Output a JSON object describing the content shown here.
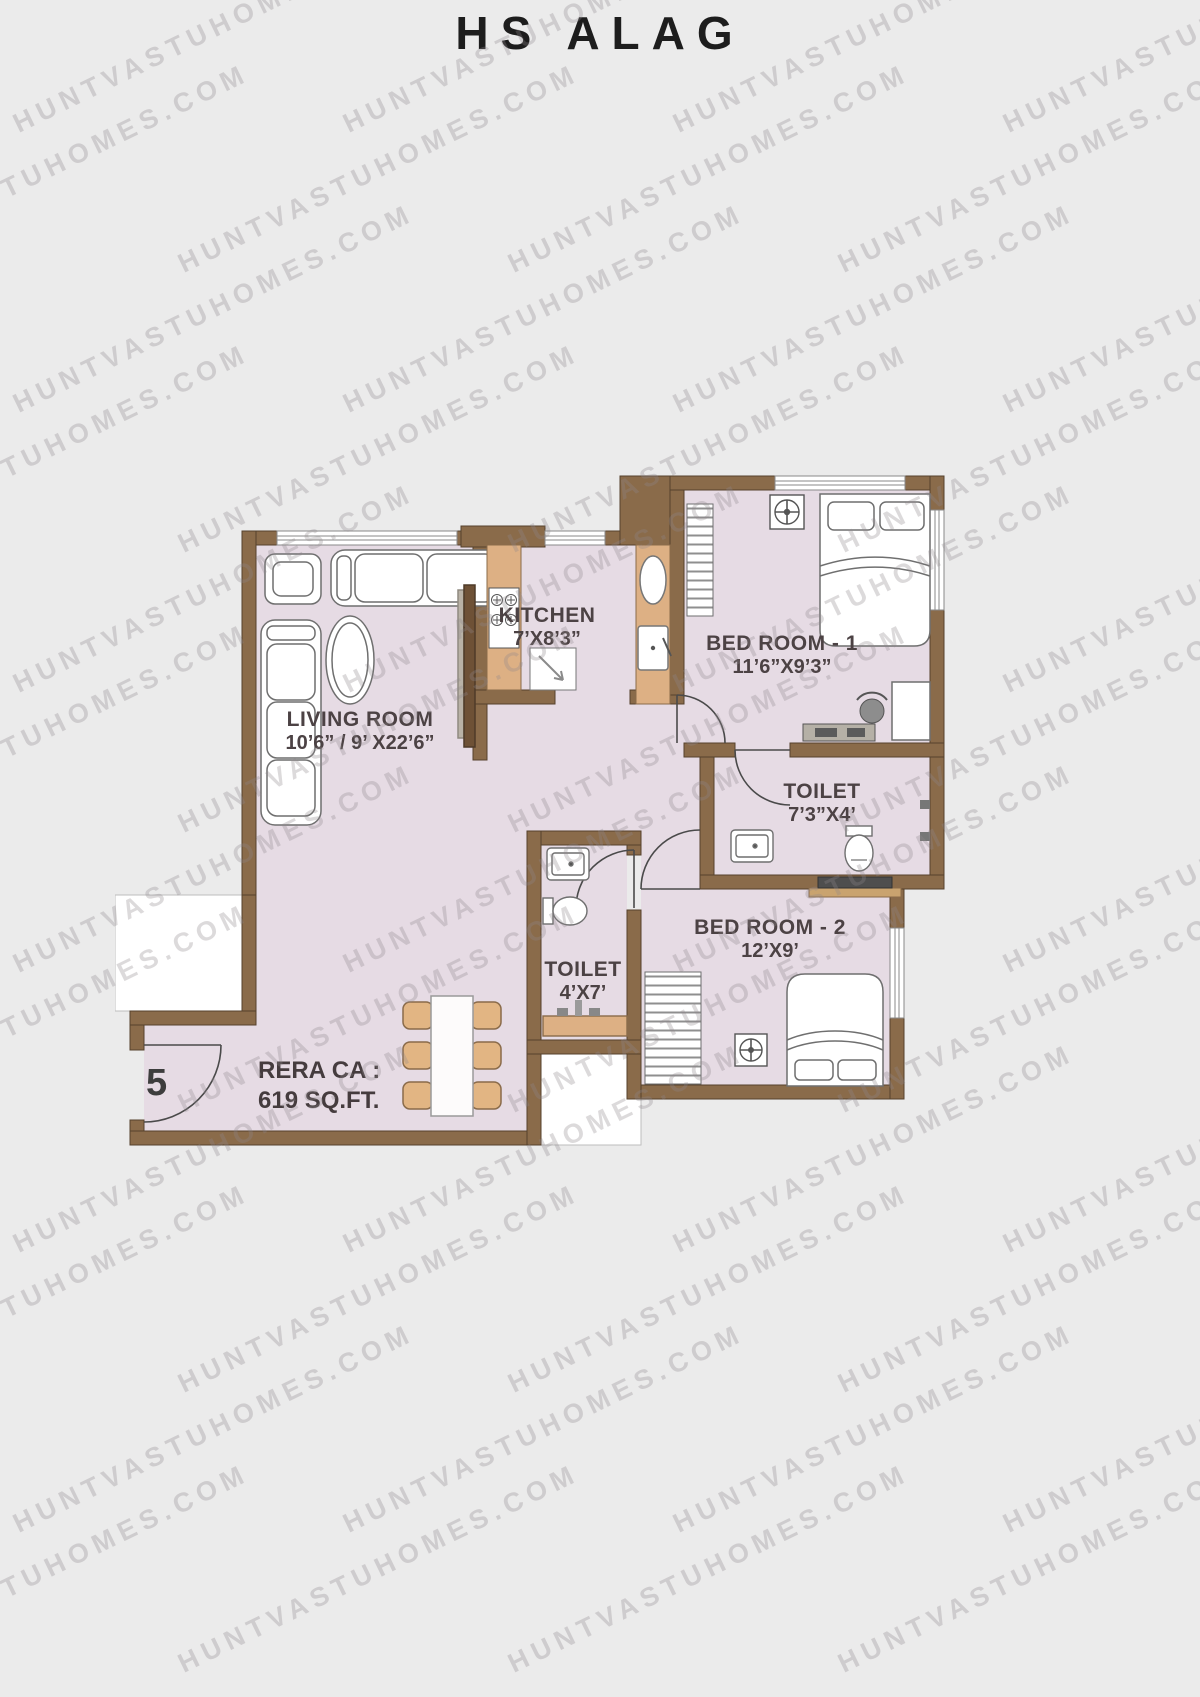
{
  "title": "HS ALAG",
  "watermark": {
    "text": "HUNTVASTUHOMES.COM"
  },
  "unit_number": "5",
  "area_label": {
    "line1": "RERA CA :",
    "line2": "619 SQ.FT."
  },
  "rooms": {
    "living": {
      "name": "LIVING ROOM",
      "dims": "10’6” / 9’ X22’6”"
    },
    "kitchen": {
      "name": "KITCHEN",
      "dims": "7’X8’3”"
    },
    "bedroom1": {
      "name": "BED ROOM - 1",
      "dims": "11’6”X9’3”"
    },
    "toilet1": {
      "name": "TOILET",
      "dims": "7’3”X4’"
    },
    "bedroom2": {
      "name": "BED ROOM - 2",
      "dims": "12’X9’"
    },
    "toilet2": {
      "name": "TOILET",
      "dims": "4’X7’"
    }
  },
  "colors": {
    "page_bg": "#ebebeb",
    "wall": "#8a6b4a",
    "wall_outline": "#55412c",
    "room_fill": "#e6dbe4",
    "counter_tan": "#ddb084",
    "chair_tan": "#e2b583",
    "exterior_white": "#ffffff",
    "furniture_stroke": "#6f6f6f",
    "label_text": "#4c4244",
    "title_text": "#1d1d1d"
  }
}
